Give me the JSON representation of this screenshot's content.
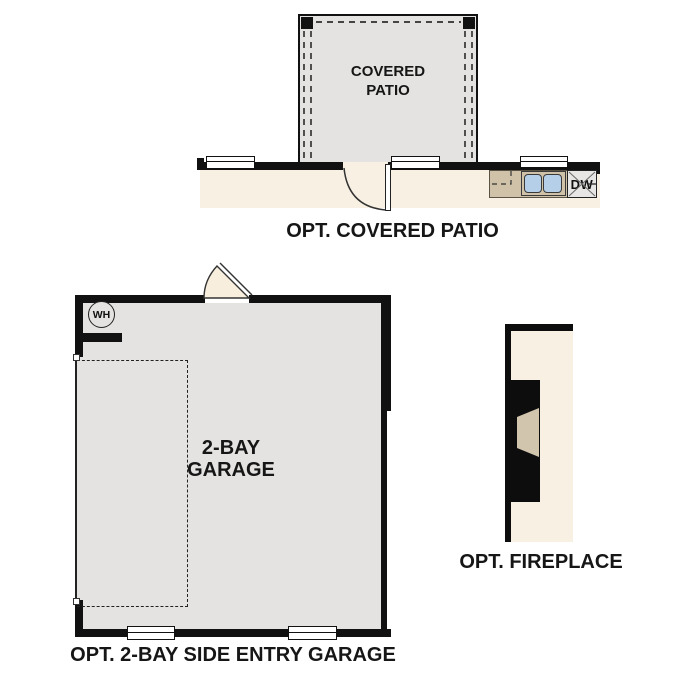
{
  "document": {
    "kind": "architectural floor plan options sheet",
    "background": "#ffffff"
  },
  "colors": {
    "wall": "#111111",
    "room_fill": "#e4e3e1",
    "interior_floor": "#f8f1e3",
    "counter": "#cfc2a9",
    "sink_basin": "#b5cfe9",
    "door": "#f7eedd",
    "firebox": "#d2c5ae",
    "text": "#161616"
  },
  "sections": {
    "covered_patio": {
      "section_label": "OPT. COVERED PATIO",
      "room_label": [
        "COVERED",
        "PATIO"
      ],
      "dishwasher_label": "DW"
    },
    "garage": {
      "section_label": "OPT. 2-BAY SIDE ENTRY GARAGE",
      "room_label": [
        "2-BAY",
        "GARAGE"
      ],
      "water_heater_label": "WH"
    },
    "fireplace": {
      "section_label": "OPT. FIREPLACE"
    }
  }
}
